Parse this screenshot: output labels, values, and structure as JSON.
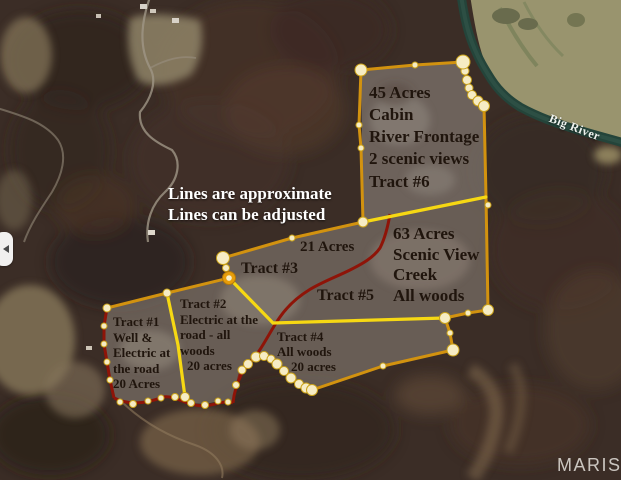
{
  "notice": {
    "line1": "Lines are approximate",
    "line2": "Lines can be adjusted"
  },
  "river": {
    "label": "Big River"
  },
  "watermark": "MARIS",
  "tracts": {
    "t1": {
      "lines": [
        "Tract #1",
        "Well &",
        "Electric at",
        "the road",
        "20 Acres"
      ]
    },
    "t2": {
      "lines": [
        "Tract #2",
        "Electric at the",
        "road - all",
        "woods",
        "20 acres"
      ]
    },
    "t3": {
      "acreage": "21 Acres",
      "name": "Tract #3"
    },
    "t4": {
      "lines": [
        "Tract #4",
        "All woods",
        "20 acres"
      ]
    },
    "t5": {
      "name": "Tract #5",
      "lines": [
        "63 Acres",
        "Scenic View",
        "Creek",
        "All woods"
      ]
    },
    "t6": {
      "lines": [
        "45 Acres",
        "Cabin",
        "River Frontage",
        "2 scenic views",
        "Tract #6"
      ]
    }
  },
  "colors": {
    "boundary_gold": "#d2920f",
    "boundary_bright": "#f6d813",
    "road_red": "#8e1408",
    "river_teal": "#24443a",
    "vertex_dot": "#f6ecc4",
    "label_dark": "#20150d",
    "label_light": "#ffffff",
    "watermark_gray": "#e4e0db"
  }
}
